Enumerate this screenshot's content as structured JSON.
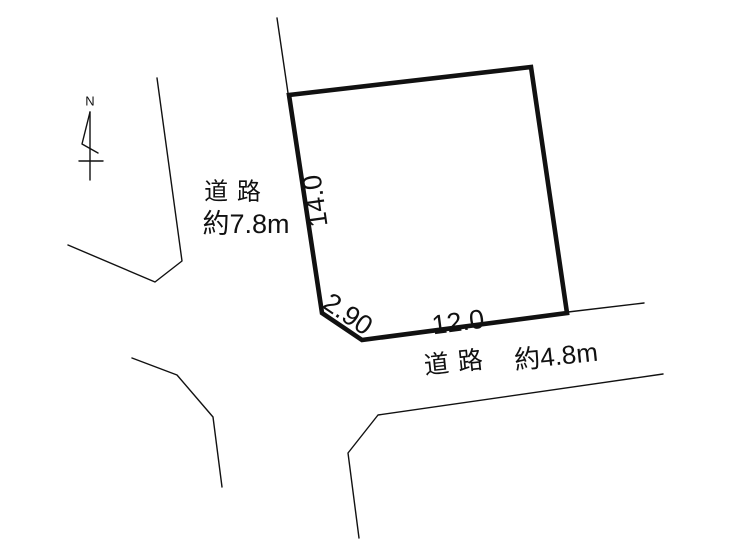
{
  "compass": {
    "north_label": "N"
  },
  "roads": {
    "west": {
      "name_label": "道 路",
      "width_label": "約7.8m"
    },
    "south": {
      "name_label": "道 路",
      "width_label": "約4.8m"
    }
  },
  "plot_dimensions": {
    "west_side_m": "14.0",
    "southwest_side_m": "2.90",
    "south_side_m": "12.0"
  },
  "colors": {
    "line": "#111111",
    "background": "#ffffff"
  }
}
